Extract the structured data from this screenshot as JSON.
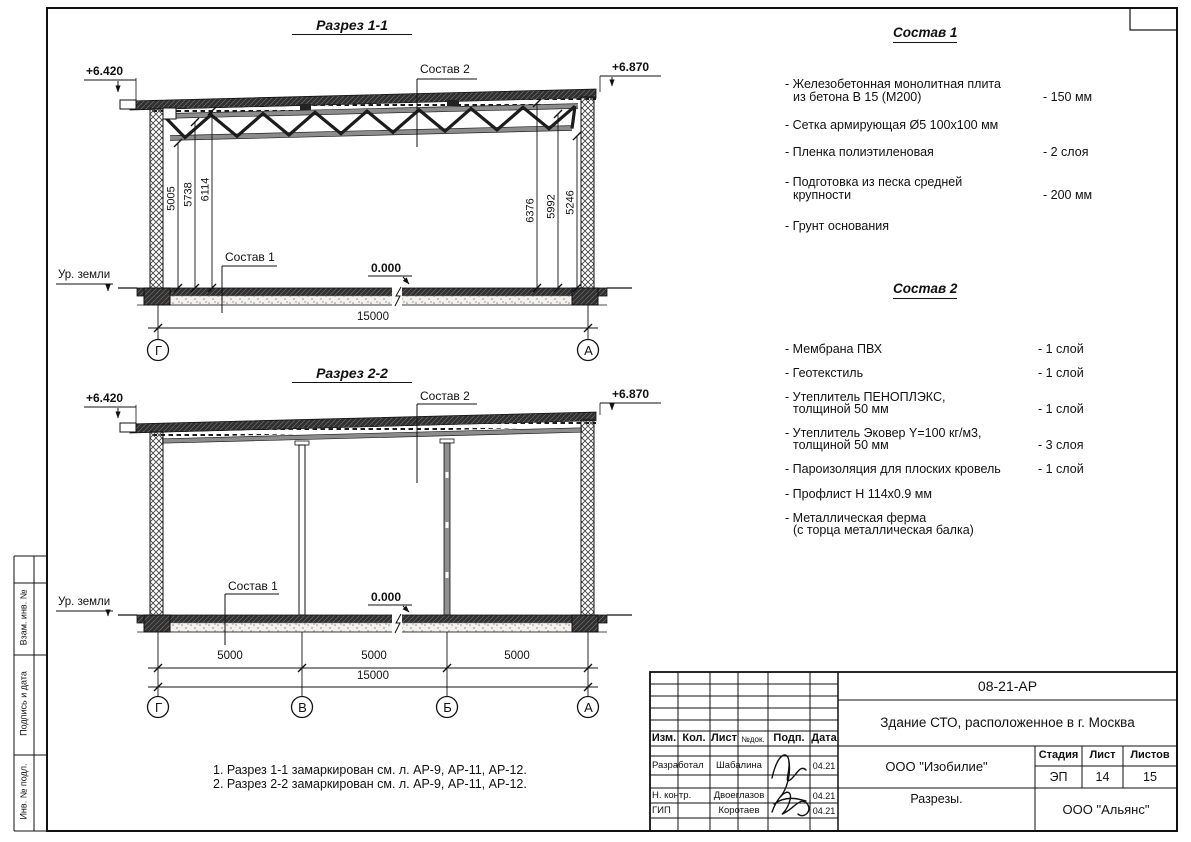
{
  "labels": {
    "sostav1": "Состав 1",
    "sostav2": "Состав 2",
    "ground": "Ур. земли",
    "zero": "0.000",
    "level_left": "+6.420",
    "level_right": "+6.870"
  },
  "section1": {
    "title": "Разрез 1-1",
    "dims_left": [
      "5005",
      "5738",
      "6114"
    ],
    "dims_right": [
      "6376",
      "5992",
      "5246"
    ],
    "dim_total": "15000",
    "axes": [
      "Г",
      "А"
    ]
  },
  "section2": {
    "title": "Разрез 2-2",
    "dims_span": [
      "5000",
      "5000",
      "5000"
    ],
    "dim_total": "15000",
    "axes": [
      "Г",
      "В",
      "Б",
      "А"
    ]
  },
  "sostav1": {
    "title": "Состав 1",
    "items": [
      {
        "line1": "- Железобетонная  монолитная плита",
        "line2": "из бетона В 15 (М200)",
        "value": "- 150 мм"
      },
      {
        "line1": "- Сетка армирующая Ø5 100х100 мм",
        "line2": "",
        "value": ""
      },
      {
        "line1": "- Пленка полиэтиленовая",
        "line2": "",
        "value": "-  2 слоя"
      },
      {
        "line1": "- Подготовка из песка средней",
        "line2": "крупности",
        "value": "- 200 мм"
      },
      {
        "line1": "- Грунт основания",
        "line2": "",
        "value": ""
      }
    ]
  },
  "sostav2": {
    "title": "Состав 2",
    "items": [
      {
        "line1": "- Мембрана ПВХ",
        "line2": "",
        "value": "- 1 слой"
      },
      {
        "line1": "- Геотекстиль",
        "line2": "",
        "value": "- 1 слой"
      },
      {
        "line1": "- Утеплитель ПЕНОПЛЭКС,",
        "line2": "толщиной 50 мм",
        "value": "- 1 слой"
      },
      {
        "line1": "- Утеплитель Эковер Y=100 кг/м3,",
        "line2": "толщиной 50 мм",
        "value": "- 3 слоя"
      },
      {
        "line1": "- Пароизоляция для плоских кровель",
        "line2": "",
        "value": "- 1 слой"
      },
      {
        "line1": "- Профлист Н 114х0.9 мм",
        "line2": "",
        "value": ""
      },
      {
        "line1": "- Металлическая ферма",
        "line2": "(с торца металлическая балка)",
        "value": ""
      }
    ]
  },
  "notes": [
    "1. Разрез 1-1 замаркирован см. л. АР-9, АР-11, АР-12.",
    "2. Разрез 2-2 замаркирован см. л. АР-9, АР-11, АР-12."
  ],
  "frame": {
    "vzam": "Взам. инв. №",
    "podpis": "Подпись и дата",
    "inv": "Инв. № подл."
  },
  "titleblock": {
    "doc_number": "08-21-АР",
    "project": "Здание СТО, расположенное в г. Москва",
    "company": "ООО \"Изобилие\"",
    "drawing_name": "Разрезы.",
    "contractor": "ООО \"Альянс\"",
    "stage_label": "Стадия",
    "sheet_label": "Лист",
    "sheets_label": "Листов",
    "stage": "ЭП",
    "sheet_no": "14",
    "sheets_total": "15",
    "cols": [
      "Изм.",
      "Кол.",
      "Лист",
      "№док.",
      "Подп.",
      "Дата"
    ],
    "rows": [
      {
        "role": "Разработал",
        "name": "Шабалина",
        "date": "04.21"
      },
      {
        "role": "Н. контр.",
        "name": "Двоеглазов",
        "date": "04.21"
      },
      {
        "role": "ГИП",
        "name": "Коротаев",
        "date": "04.21"
      }
    ]
  }
}
